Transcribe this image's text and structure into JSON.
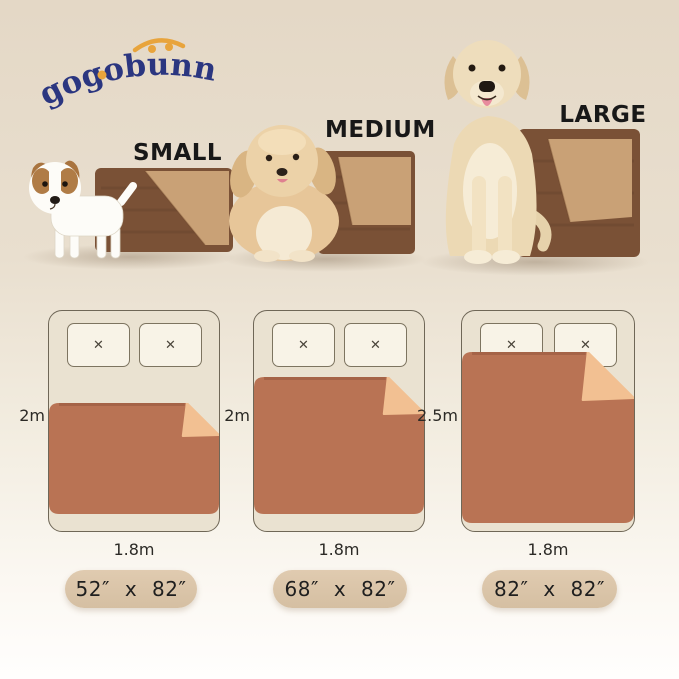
{
  "brand": {
    "name": "gogobunny"
  },
  "sizes": [
    {
      "id": "small",
      "label": "SMALL",
      "mattress_length": "2m",
      "mattress_width": "1.8m",
      "blanket_size": "52″ x 82″"
    },
    {
      "id": "medium",
      "label": "MEDIUM",
      "mattress_length": "2m",
      "mattress_width": "1.8m",
      "blanket_size": "68″ x 82″"
    },
    {
      "id": "large",
      "label": "LARGE",
      "mattress_length": "2.5m",
      "mattress_width": "1.8m",
      "blanket_size": "82″ x 82″"
    }
  ],
  "icons": {
    "pillow_mark": "✕"
  },
  "colors": {
    "logo_navy": "#2b3680",
    "accent_orange": "#e8a43c",
    "photo_blanket_top": "#7a5136",
    "photo_blanket_underside": "#c9a176",
    "diagram_blanket": "#b97354",
    "diagram_blanket_fold": "#f2c092",
    "bed_fill": "#eae2d1",
    "pillow_fill": "#f8f3e7",
    "pill_bg": "#d9c3a7",
    "background_top": "#e4d8c6",
    "background_bottom": "#fffefd"
  }
}
